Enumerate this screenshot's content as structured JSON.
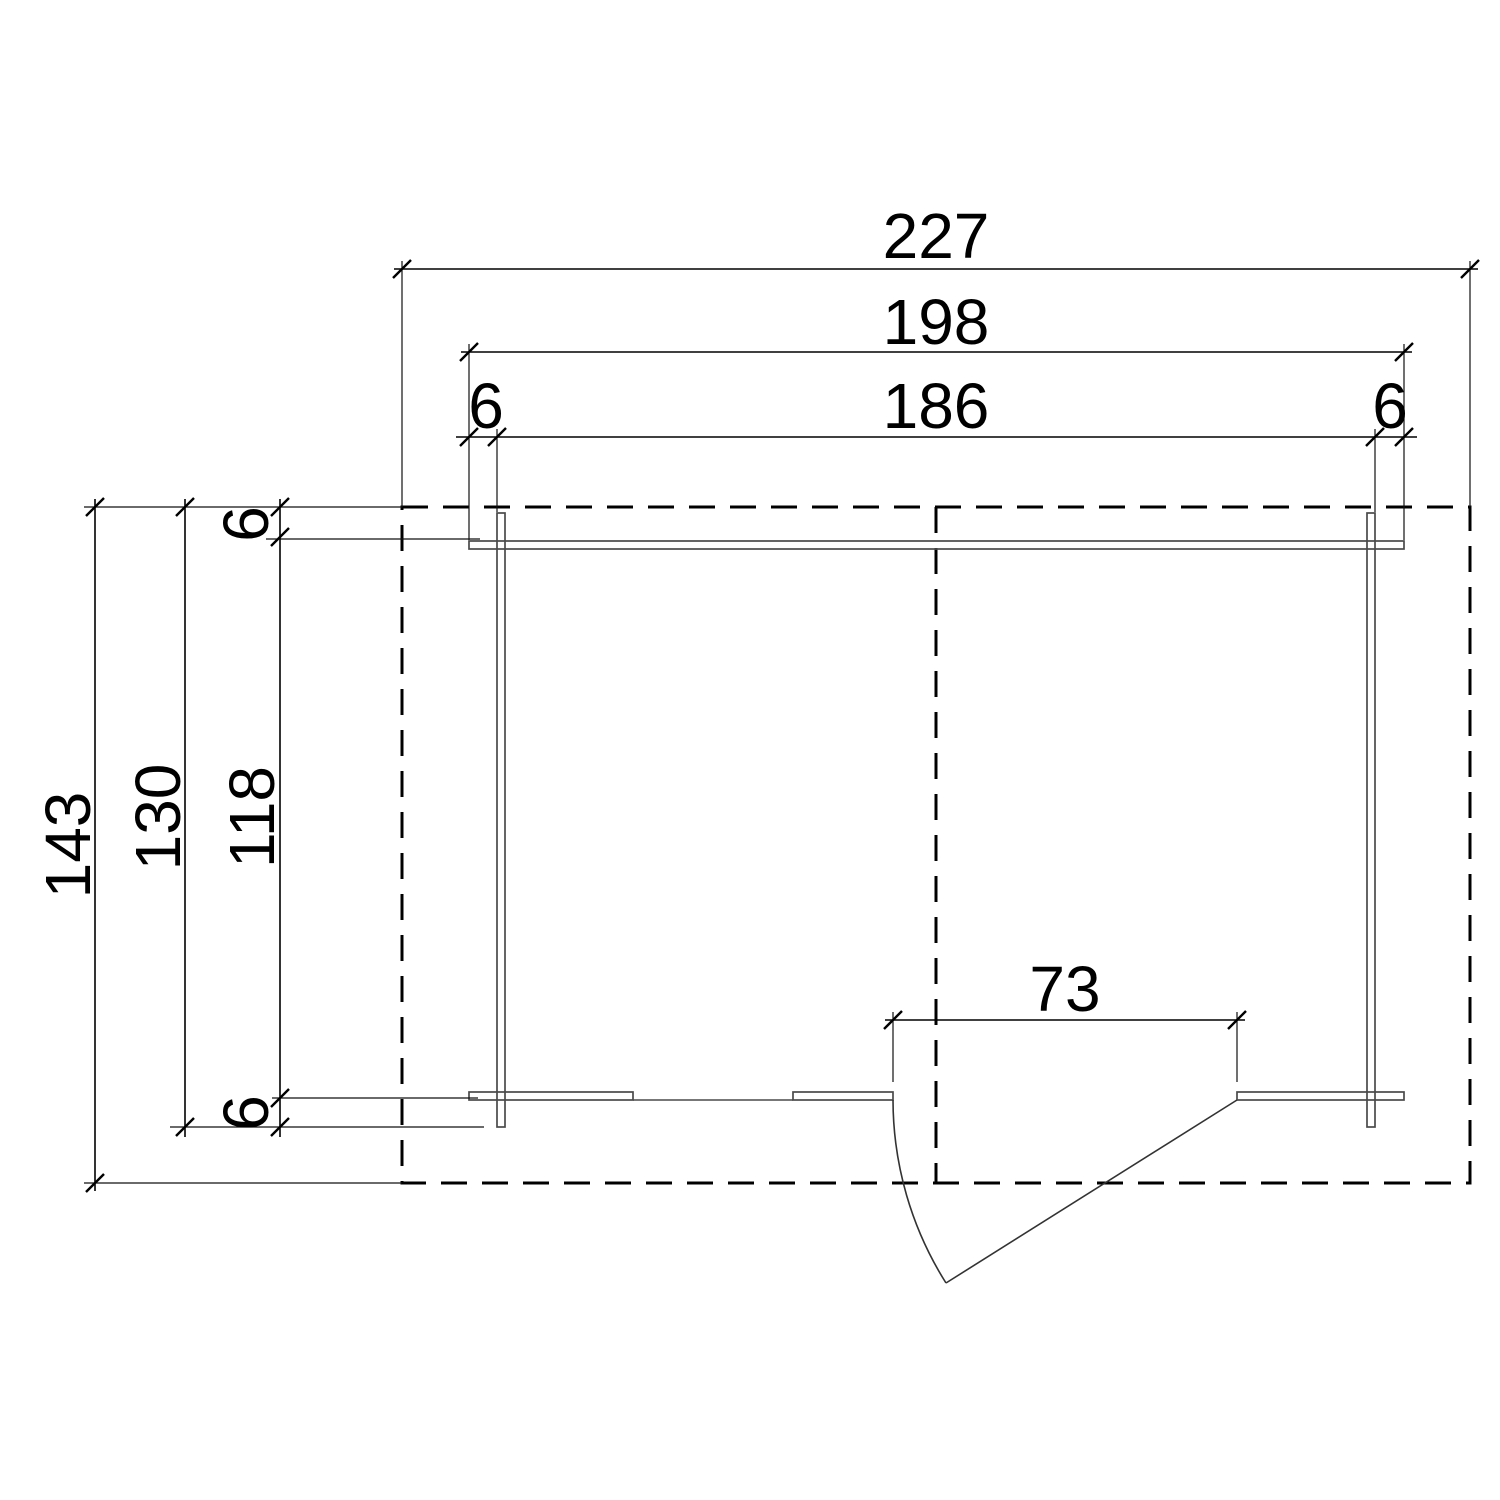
{
  "drawing": {
    "kind": "log-cabin-floor-plan-top-view",
    "background_color": "#ffffff",
    "dimension_line_color": "#000000",
    "structure_line_color": "#4a4a4a",
    "labels": {
      "roof_width": "227",
      "log_width": "198",
      "wall_width": "186",
      "log_end_left": "6",
      "log_end_right": "6",
      "roof_depth": "143",
      "log_depth": "130",
      "wall_depth": "118",
      "log_end_top": "6",
      "log_end_bottom": "6",
      "door_width": "73"
    }
  }
}
